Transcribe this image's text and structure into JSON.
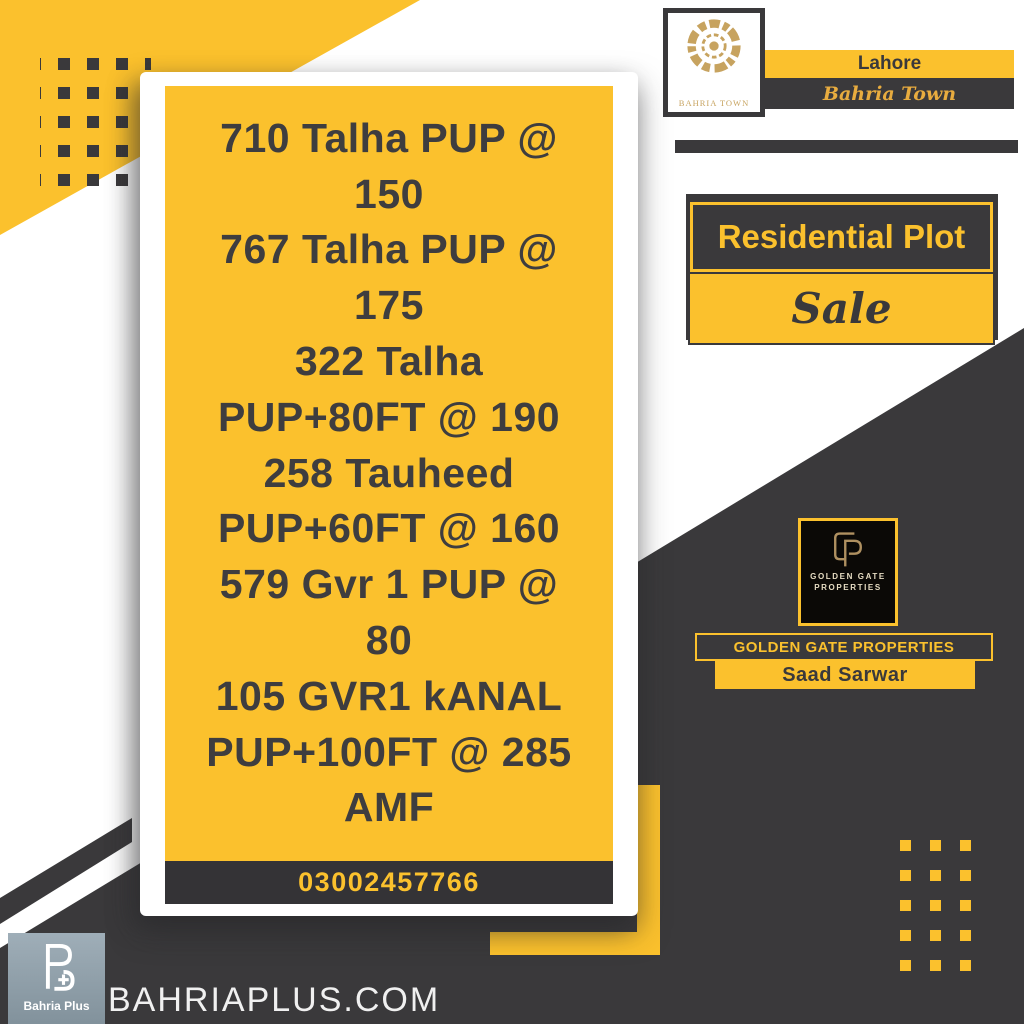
{
  "header": {
    "city": "Lahore",
    "brand_script": "Bahria Town",
    "emblem_caption": "BAHRIA TOWN"
  },
  "offer": {
    "category": "Residential Plot",
    "deal_type": "Sale"
  },
  "card": {
    "lines": [
      "710 Talha PUP @",
      "150",
      "767 Talha PUP @",
      "175",
      "322 Talha",
      "PUP+80FT @ 190",
      "258 Tauheed",
      "PUP+60FT @ 160",
      "579 Gvr 1 PUP @",
      "80",
      "105 GVR1 kANAL",
      "PUP+100FT @ 285",
      "AMF"
    ],
    "phone": "03002457766"
  },
  "agency": {
    "logo_line1": "GOLDEN GATE",
    "logo_line2": "PROPERTIES",
    "name": "GOLDEN GATE PROPERTIES",
    "agent": "Saad Sarwar"
  },
  "footer": {
    "site": "BAHRIAPLUS.COM",
    "logo_label": "Bahria Plus"
  },
  "colors": {
    "yellow": "#FBC12D",
    "dark": "#3A393B",
    "gold": "#C7A35F",
    "script_gold": "#E8AC3F",
    "steel": "#8FA0AB"
  }
}
